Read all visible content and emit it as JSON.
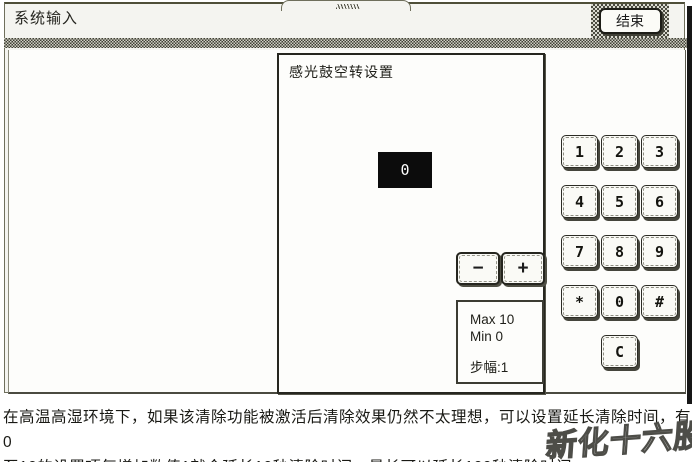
{
  "window": {
    "title": "系统输入",
    "end_button": "结束"
  },
  "dialog": {
    "title": "感光鼓空转设置",
    "value": "0",
    "decrement": "−",
    "increment": "+",
    "limits": {
      "max": "Max 10",
      "min": "Min 0",
      "step": "步幅:1"
    }
  },
  "keypad": {
    "keys": [
      "1",
      "2",
      "3",
      "4",
      "5",
      "6",
      "7",
      "8",
      "9",
      "*",
      "0",
      "#"
    ],
    "clear": "C"
  },
  "footer": {
    "line1": "在高温高湿环境下，如果该清除功能被激活后清除效果仍然不太理想，可以设置延长清除时间，有0",
    "line2": "至10的设置项每增加数值1就会延长10秒清除时间，最长可以延长100秒清除时间。"
  },
  "watermark": "新化十六股",
  "colors": {
    "display_bg": "#0c0c0c",
    "display_text": "#ffffff",
    "chrome_bg": "#f4f4f0"
  }
}
